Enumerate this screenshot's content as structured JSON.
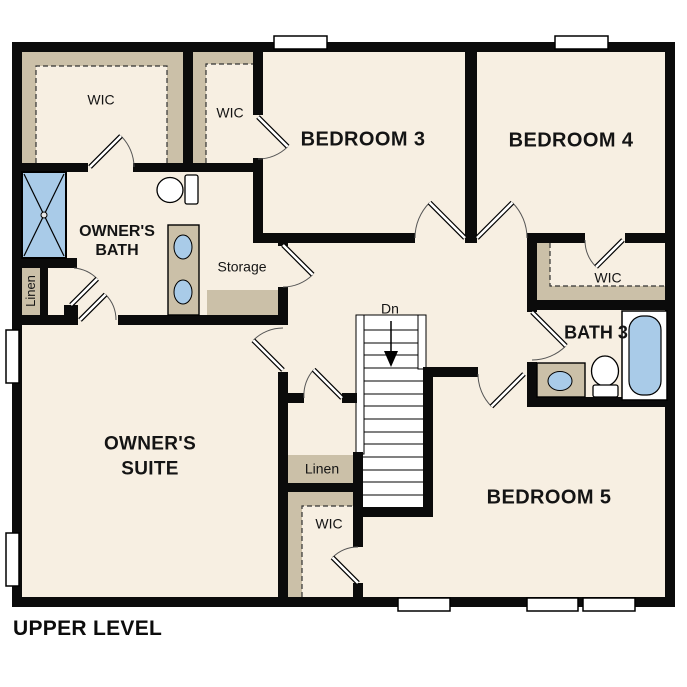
{
  "plan": {
    "title": "UPPER LEVEL",
    "rooms": {
      "owner_suite": {
        "line1": "OWNER'S",
        "line2": "SUITE"
      },
      "owner_bath": {
        "line1": "OWNER'S",
        "line2": "BATH"
      },
      "bedroom3": "BEDROOM 3",
      "bedroom4": "BEDROOM 4",
      "bedroom5": "BEDROOM 5",
      "bath3": "BATH 3",
      "wic_owner": "WIC",
      "wic_bedroom3": "WIC",
      "wic_bedroom4": "WIC",
      "wic_bedroom5": "WIC",
      "linen_bath": "Linen",
      "linen_hall": "Linen",
      "storage": "Storage",
      "stair_direction": "Dn"
    },
    "colors": {
      "wall": "#0b0b0b",
      "floor": "#F7EFE2",
      "closet_shelf": "#CBC0A8",
      "fixture_blue": "#A9CBE8",
      "background": "#FFFFFF"
    }
  }
}
